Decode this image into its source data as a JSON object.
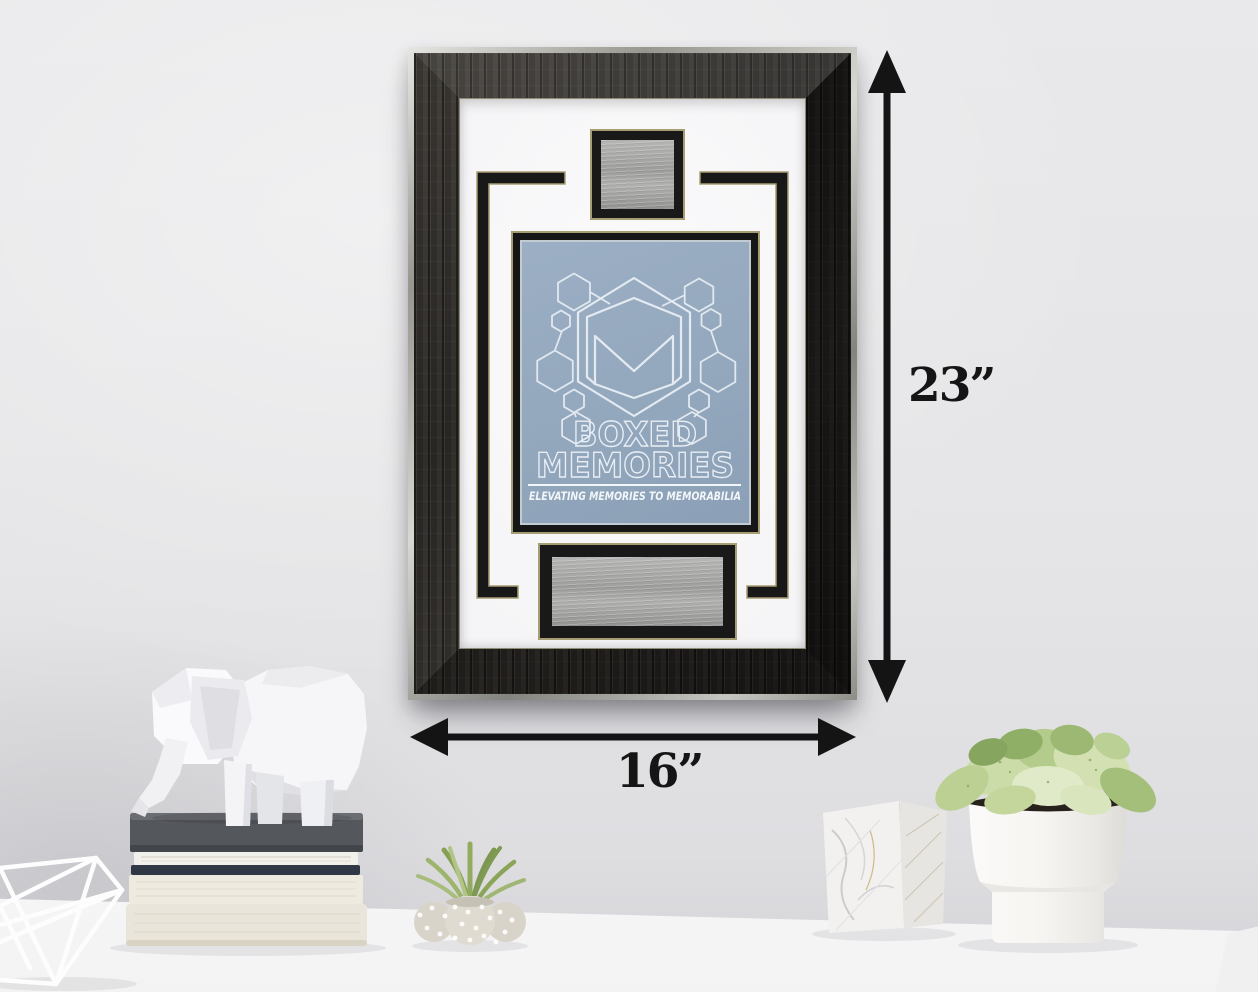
{
  "dimensions": {
    "height_label": "23”",
    "width_label": "16”"
  },
  "insert": {
    "logo_name": "hexagon-m-monogram",
    "brand_line1": "BOXED",
    "brand_line2": "MEMORIES",
    "tagline": "ELEVATING MEMORIES TO MEMORABILIA"
  },
  "colors": {
    "wall": "#e5e5e7",
    "desk": "#fafafa",
    "frame_wood": "#2b2927",
    "frame_silver_edge": "#bcbcb8",
    "mat": "#f6f6f8",
    "accent_black": "#1a1a1a",
    "gold_pinstripe": "#a79d72",
    "panel_blue": "#93a7bd",
    "logo_outline": "#e8eef4",
    "plate_silver": "#a9a9a7",
    "arrow": "#141414"
  },
  "props": {
    "left": [
      "wire-basket",
      "stacked-books",
      "geometric-elephant-figurine"
    ],
    "center": [
      "air-plant-in-dotted-pot"
    ],
    "right": [
      "marble-pencil-cup",
      "white-potted-plant"
    ]
  }
}
